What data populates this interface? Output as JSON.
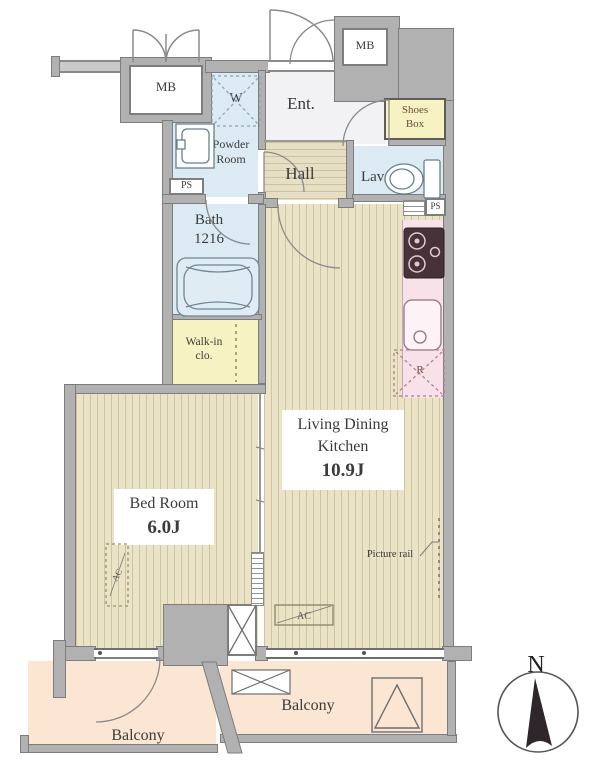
{
  "plan_type": "apartment-floor-plan",
  "labels": {
    "mb_left": "MB",
    "mb_right": "MB",
    "washer": "W",
    "entrance": "Ent.",
    "shoes_box": [
      "Shoes",
      "Box"
    ],
    "powder_room": [
      "Powder",
      "Room"
    ],
    "hall": "Hall",
    "lavatory": "Lav.",
    "ps_left": "PS",
    "ps_right": "PS",
    "bath": [
      "Bath",
      "1216"
    ],
    "walk_in_closet": [
      "Walk-in",
      "clo."
    ],
    "refrigerator": "R",
    "ldk": [
      "Living Dining",
      "Kitchen",
      "10.9J"
    ],
    "bedroom": [
      "Bed Room",
      "6.0J"
    ],
    "picture_rail": "Picture rail",
    "ac_bedroom": "AC",
    "ac_ldk": "AC",
    "balcony_left": "Balcony",
    "balcony_center": "Balcony",
    "compass_north": "N"
  },
  "colors": {
    "floor_wood_beige": "#eae3c6",
    "floor_wet_blue": "#dcebf3",
    "floor_storage_yellow": "#f7f2c1",
    "floor_kitchen_pink": "#f8e1e9",
    "floor_balcony_peach": "#fbe6d4",
    "wall_gray": "#b1b1b1",
    "stove_dark": "#463238",
    "text_ink": "#3b3b3b"
  }
}
